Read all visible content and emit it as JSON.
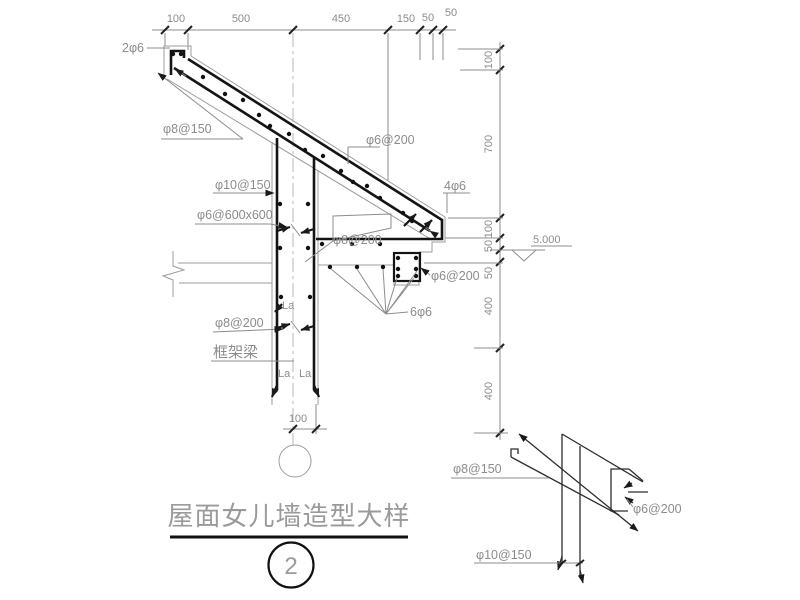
{
  "title_block": {
    "title": "屋面女儿墙造型大样",
    "detail_number": "2"
  },
  "dimensions": {
    "top": [
      "100",
      "500",
      "450",
      "150",
      "50",
      "50"
    ],
    "right": [
      "100",
      "700",
      "100",
      "50",
      "50",
      "400",
      "400"
    ],
    "wall_bottom": "100",
    "elevation": "5.000"
  },
  "rebar_labels": {
    "upturn_bars": "2φ6",
    "slope_main_bar": "φ8@150",
    "wall_vertical_bars": "φ10@150",
    "wall_mesh": "φ6@600x600",
    "slope_distribution_bars": "φ6@200",
    "corner_bars": "4φ6",
    "slope_mid_label": "φ8@200",
    "wall_horizontal_bars": "φ8@200",
    "edge_beam_stirrup": "φ6@200",
    "edge_beam_bars": "6φ6",
    "frame_beam": "框架梁",
    "lap_a": "La",
    "lap_b": "La",
    "lap_c": "La"
  },
  "shape_detail": {
    "bar_top": "φ8@150",
    "bar_vertical": "φ10@150",
    "bar_stirrup": "φ6@200"
  }
}
